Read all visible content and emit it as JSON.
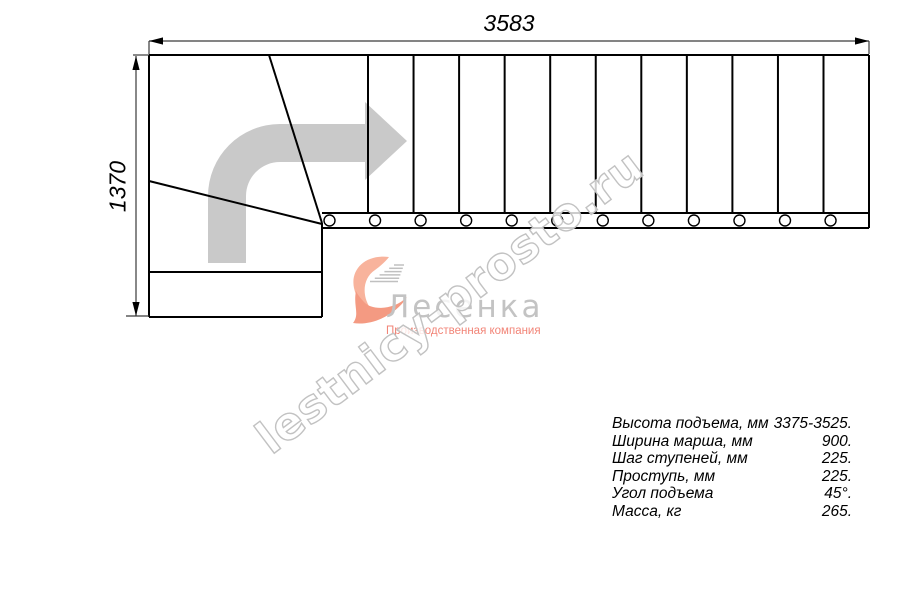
{
  "page": {
    "background": "#ffffff"
  },
  "drawing": {
    "dimension_top": "3583",
    "dimension_left": "1370",
    "tread_line_count": 11,
    "circle_count": 12,
    "line_color": "#000000",
    "dim_line_color": "#3a3a3a",
    "direction_arrow_color": "#c9c9c9"
  },
  "logo": {
    "company_name": "Лесенка",
    "tagline": "Производственная компания",
    "name_color": "#c3c3c3",
    "accent_color": "#f28578",
    "mark_color_top": "#f8b39c",
    "mark_color_bottom": "#f49a82",
    "speed_lines_color": "#c0c0c0"
  },
  "watermark": {
    "text": "lestnicy-prosto.ru",
    "outline_color": "#c2c2c2",
    "fill_color": "#ffffff"
  },
  "specs": {
    "rows": [
      {
        "label": "Высота подъема, мм",
        "value": "3375-3525."
      },
      {
        "label": "Ширина марша, мм",
        "value": "900."
      },
      {
        "label": "Шаг ступеней, мм",
        "value": "225."
      },
      {
        "label": "Проступь, мм",
        "value": "225."
      },
      {
        "label": "Угол подъема",
        "value": "45°."
      },
      {
        "label": "Масса, кг",
        "value": "265."
      }
    ]
  }
}
